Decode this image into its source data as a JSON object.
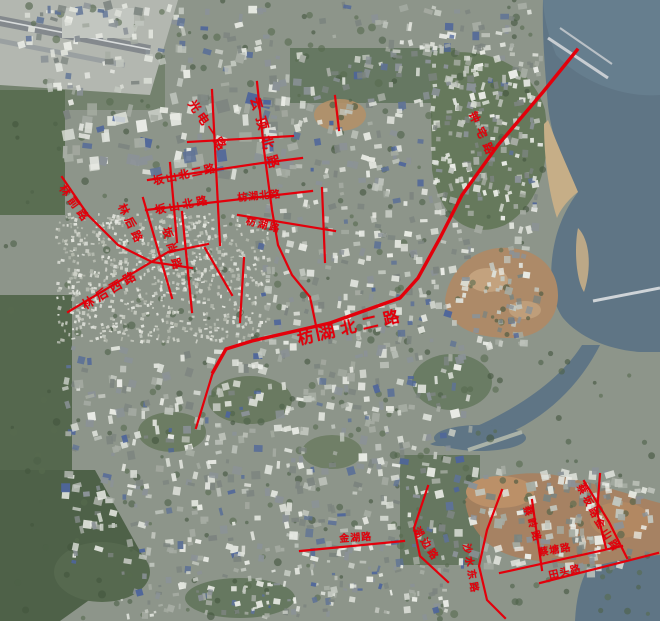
{
  "map": {
    "road_color": "#e3000b",
    "label_color": "#e3000b",
    "sea_color": "#5f7585",
    "land_color": "#8d958a",
    "labels": [
      {
        "text": "光电一路",
        "x": 196,
        "y": 98,
        "rot": 56,
        "size": 12,
        "ls": 3
      },
      {
        "text": "云顶北路",
        "x": 260,
        "y": 96,
        "rot": 74,
        "size": 13,
        "ls": 7
      },
      {
        "text": "坂山北二路",
        "x": 152,
        "y": 176,
        "rot": -12,
        "size": 11,
        "ls": 2
      },
      {
        "text": "坂山北路",
        "x": 154,
        "y": 205,
        "rot": -11,
        "size": 11,
        "ls": 3
      },
      {
        "text": "林前路",
        "x": 66,
        "y": 183,
        "rot": 54,
        "size": 11,
        "ls": 4
      },
      {
        "text": "林后路",
        "x": 126,
        "y": 202,
        "rot": 64,
        "size": 11,
        "ls": 4
      },
      {
        "text": "坂尚路",
        "x": 171,
        "y": 226,
        "rot": 74,
        "size": 11,
        "ls": 5
      },
      {
        "text": "林后西路",
        "x": 80,
        "y": 301,
        "rot": -31,
        "size": 12,
        "ls": 4
      },
      {
        "text": "枋湖北路",
        "x": 237,
        "y": 194,
        "rot": -5,
        "size": 10,
        "ls": 1
      },
      {
        "text": "枋湖路",
        "x": 247,
        "y": 217,
        "rot": 14,
        "size": 10,
        "ls": 2
      },
      {
        "text": "枋湖北二路",
        "x": 296,
        "y": 332,
        "rot": -13,
        "size": 16,
        "ls": 6
      },
      {
        "text": "钟宅路",
        "x": 477,
        "y": 110,
        "rot": 66,
        "size": 11,
        "ls": 6
      },
      {
        "text": "金湖路",
        "x": 339,
        "y": 535,
        "rot": -4,
        "size": 10,
        "ls": 1
      },
      {
        "text": "湖边路",
        "x": 419,
        "y": 526,
        "rot": 57,
        "size": 10,
        "ls": 3
      },
      {
        "text": "沙水东路",
        "x": 470,
        "y": 543,
        "rot": 80,
        "size": 10,
        "ls": 3
      },
      {
        "text": "蔡岭路",
        "x": 530,
        "y": 505,
        "rot": 72,
        "size": 10,
        "ls": 3
      },
      {
        "text": "蔡塘路",
        "x": 538,
        "y": 549,
        "rot": -10,
        "size": 10,
        "ls": 1
      },
      {
        "text": "蔡坂路",
        "x": 583,
        "y": 483,
        "rot": 63,
        "size": 10,
        "ls": 3
      },
      {
        "text": "金山路",
        "x": 600,
        "y": 517,
        "rot": 57,
        "size": 10,
        "ls": 3
      },
      {
        "text": "田头路",
        "x": 548,
        "y": 572,
        "rot": -13,
        "size": 10,
        "ls": 1
      }
    ],
    "roads": [
      {
        "points": "188,142 293,136"
      },
      {
        "points": "212,90 220,245"
      },
      {
        "points": "257,82 264,150 272,210 278,245 292,275 310,297"
      },
      {
        "points": "148,180 262,163 302,158"
      },
      {
        "points": "146,210 312,191"
      },
      {
        "points": "62,177 88,215 118,245 152,262 192,268"
      },
      {
        "points": "143,198 172,298"
      },
      {
        "points": "182,212 192,312"
      },
      {
        "points": "68,312 168,252 208,244"
      },
      {
        "points": "170,163 177,242"
      },
      {
        "points": "238,215 335,231"
      },
      {
        "points": "322,188 325,262"
      },
      {
        "points": "577,50 543,92 498,145 462,195 440,238 418,278 400,298 330,323 252,341 226,349 213,372",
        "w": 3.4
      },
      {
        "points": "213,372 196,428"
      },
      {
        "points": "310,297 319,340"
      },
      {
        "points": "300,551 404,541"
      },
      {
        "points": "428,486 414,528 420,556 448,582"
      },
      {
        "points": "502,490 487,530 479,566 487,600 505,618"
      },
      {
        "points": "532,500 542,570"
      },
      {
        "points": "500,573 622,546"
      },
      {
        "points": "584,481 609,522 627,558"
      },
      {
        "points": "600,474 597,512 606,548"
      },
      {
        "points": "540,583 658,553"
      },
      {
        "points": "335,96 339,130"
      },
      {
        "points": "205,248 232,295"
      },
      {
        "points": "244,258 240,322"
      }
    ]
  }
}
